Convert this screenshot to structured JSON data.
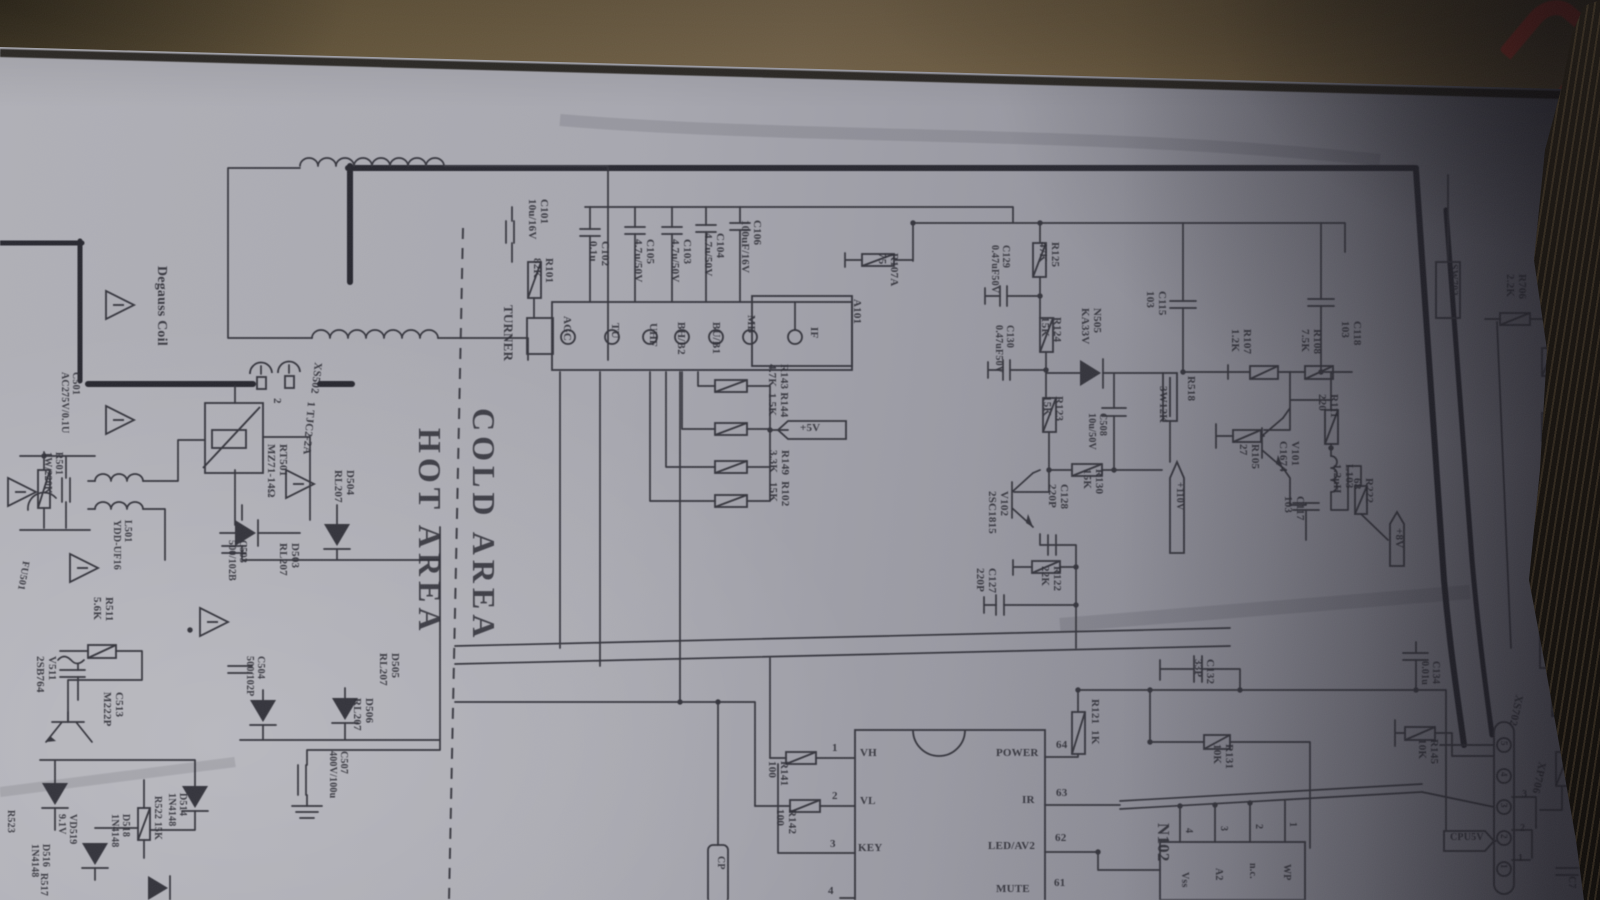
{
  "description": "Photograph of a CRT TV power/tuner schematic sheet lying on cardboard",
  "colors": {
    "paper": "#a7a7af",
    "cardboard": "#6a5a3e",
    "fabric": "#120e0a",
    "ink": "#33333b",
    "red_mark": "#9c2d24"
  },
  "areas": {
    "cold": "COLD AREA",
    "hot": "HOT AREA"
  },
  "labels": [
    {
      "n": "degauss-coil-label",
      "t": "Degauss Coil",
      "x": 168,
      "y": 266,
      "s": 14
    },
    {
      "n": "xs502-ref",
      "t": "XS502",
      "x": 323,
      "y": 363,
      "r": 97
    },
    {
      "n": "xs502-pin2",
      "t": "2",
      "x": 282,
      "y": 398
    },
    {
      "n": "xs502-pin1-type",
      "t": "1 TJC2-2A",
      "x": 316,
      "y": 402,
      "r": 95
    },
    {
      "n": "rt501-label",
      "t": "RT501\nMZ71-14Ω",
      "x": 288,
      "y": 444
    },
    {
      "n": "c501-label",
      "t": "C501\nAC275V/0.1U",
      "x": 80,
      "y": 372,
      "s": 10
    },
    {
      "n": "r501-label",
      "t": "R501\n1W/220K",
      "x": 63,
      "y": 452,
      "s": 10
    },
    {
      "n": "l501-label",
      "t": "L501\nYDD-UF16",
      "x": 132,
      "y": 520,
      "s": 10
    },
    {
      "n": "fu501-label",
      "t": "FU501",
      "x": 30,
      "y": 562,
      "s": 10,
      "r": 100
    },
    {
      "n": "r511-label",
      "t": "R511\n5.6K",
      "x": 114,
      "y": 597
    },
    {
      "n": "v511-label",
      "t": "V511\n2SB764",
      "x": 57,
      "y": 656
    },
    {
      "n": "c513-label",
      "t": "C513\nM222P",
      "x": 124,
      "y": 692
    },
    {
      "n": "d514-label",
      "t": "D514\n1N4148",
      "x": 187,
      "y": 793,
      "s": 10
    },
    {
      "n": "r522-label",
      "t": "R522 15K",
      "x": 162,
      "y": 796,
      "s": 10
    },
    {
      "n": "d518-label",
      "t": "D518\n1N4148",
      "x": 130,
      "y": 814,
      "s": 10
    },
    {
      "n": "vd519-label",
      "t": "VD519\n9.1V",
      "x": 77,
      "y": 814,
      "s": 10
    },
    {
      "n": "d516-label",
      "t": "D516\n1N4148",
      "x": 50,
      "y": 844,
      "s": 10
    },
    {
      "n": "r523-label",
      "t": "R523",
      "x": 15,
      "y": 810,
      "s": 10
    },
    {
      "n": "r517-label",
      "t": "R517",
      "x": 48,
      "y": 873,
      "s": 10
    },
    {
      "n": "d503-label",
      "t": "D503\nRL207",
      "x": 300,
      "y": 543
    },
    {
      "n": "d504-label",
      "t": "D504\nRL207",
      "x": 355,
      "y": 470
    },
    {
      "n": "c503-label",
      "t": "C503\n500/102B",
      "x": 247,
      "y": 540,
      "s": 10
    },
    {
      "n": "c504-label",
      "t": "C504\n500/102P",
      "x": 265,
      "y": 656,
      "s": 10
    },
    {
      "n": "d505-label",
      "t": "D505\nRL207",
      "x": 400,
      "y": 653
    },
    {
      "n": "d506-label",
      "t": "D506\nRL207",
      "x": 374,
      "y": 698
    },
    {
      "n": "c507-label",
      "t": "C507\n400V/100u",
      "x": 348,
      "y": 751,
      "s": 10
    },
    {
      "n": "tuner-label",
      "t": "TURNER",
      "x": 515,
      "y": 305,
      "s": 13
    },
    {
      "n": "c101-label",
      "t": "C101\n10u/16V",
      "x": 549,
      "y": 199
    },
    {
      "n": "r101-label",
      "t": "R101\n82K",
      "x": 554,
      "y": 258
    },
    {
      "n": "c102-label",
      "t": "C102\n0.1u",
      "x": 610,
      "y": 241
    },
    {
      "n": "c105-label",
      "t": "C105\n4.7u/50V",
      "x": 655,
      "y": 239
    },
    {
      "n": "c103-label",
      "t": "C103\n4.7u/50V",
      "x": 692,
      "y": 239
    },
    {
      "n": "c104-label",
      "t": "C104\n4.7u/50V",
      "x": 725,
      "y": 233
    },
    {
      "n": "c106-label",
      "t": "C106\n100uF/16V",
      "x": 762,
      "y": 220
    },
    {
      "n": "tuner-pin-agc",
      "t": "AGC",
      "x": 572,
      "y": 316
    },
    {
      "n": "tuner-pin-tu",
      "t": "TU",
      "x": 620,
      "y": 323
    },
    {
      "n": "tuner-pin-uhf",
      "t": "UHF",
      "x": 658,
      "y": 323
    },
    {
      "n": "tuner-pin-bhb2",
      "t": "BH/B2",
      "x": 686,
      "y": 322
    },
    {
      "n": "tuner-pin-bub1",
      "t": "BU/B1",
      "x": 721,
      "y": 322
    },
    {
      "n": "tuner-pin-mb",
      "t": "MB",
      "x": 756,
      "y": 315
    },
    {
      "n": "tuner-pin-if",
      "t": "IF",
      "x": 819,
      "y": 327
    },
    {
      "n": "a101-label",
      "t": "A101",
      "x": 862,
      "y": 299
    },
    {
      "n": "r143-r144-label",
      "t": "R143 R144\n4.7K  1.5K",
      "x": 789,
      "y": 364
    },
    {
      "n": "r149-r102-label",
      "t": "R149  R102\n3.3K   15K",
      "x": 790,
      "y": 450
    },
    {
      "n": "flag-5v-label",
      "t": "+5V",
      "x": 800,
      "y": 423,
      "r": "h"
    },
    {
      "n": "r107a-label",
      "t": "R107A\n75",
      "x": 899,
      "y": 253
    },
    {
      "n": "r125-label",
      "t": "R125\n47K",
      "x": 1060,
      "y": 242
    },
    {
      "n": "c129-label",
      "t": "C129\n0.47uF50V",
      "x": 1010,
      "y": 245,
      "s": 10
    },
    {
      "n": "r124-label",
      "t": "R124\n15K",
      "x": 1062,
      "y": 317
    },
    {
      "n": "c130-label",
      "t": "C130\n0.47uF50V",
      "x": 1014,
      "y": 325,
      "s": 10
    },
    {
      "n": "n505-label",
      "t": "N505\nKA33V",
      "x": 1102,
      "y": 308
    },
    {
      "n": "r123-label",
      "t": "R123\n15K",
      "x": 1064,
      "y": 396
    },
    {
      "n": "c508-label",
      "t": "C508\n10u/50V",
      "x": 1107,
      "y": 413,
      "s": 10
    },
    {
      "n": "r130-label",
      "t": "R130\n15K",
      "x": 1104,
      "y": 469
    },
    {
      "n": "r518-ref",
      "t": "R518",
      "x": 1196,
      "y": 376
    },
    {
      "n": "r518-val",
      "t": "3W12K",
      "x": 1168,
      "y": 386
    },
    {
      "n": "flag-110v-label",
      "t": "+110V",
      "x": 1184,
      "y": 482,
      "s": 10
    },
    {
      "n": "v102-label",
      "t": "V102\n2SC1815",
      "x": 1009,
      "y": 491
    },
    {
      "n": "c128-label",
      "t": "C128\n220P",
      "x": 1069,
      "y": 484
    },
    {
      "n": "r122-label",
      "t": "R122\n22K",
      "x": 1062,
      "y": 566
    },
    {
      "n": "c127-label",
      "t": "C127\n220P",
      "x": 997,
      "y": 568
    },
    {
      "n": "c115-label",
      "t": "C115\n103",
      "x": 1167,
      "y": 291
    },
    {
      "n": "c118-label",
      "t": "C118\n103",
      "x": 1362,
      "y": 321
    },
    {
      "n": "r107-label",
      "t": "R107\n1.2K",
      "x": 1252,
      "y": 329
    },
    {
      "n": "r108-label",
      "t": "R108\n7.5K",
      "x": 1322,
      "y": 329
    },
    {
      "n": "r111-label",
      "t": "R111\n220",
      "x": 1339,
      "y": 394
    },
    {
      "n": "v101-label",
      "t": "V101\nC1674",
      "x": 1300,
      "y": 441
    },
    {
      "n": "r105-label",
      "t": "R105\n27",
      "x": 1260,
      "y": 444
    },
    {
      "n": "l103-label",
      "t": "L103\n1.2uH",
      "x": 1354,
      "y": 464
    },
    {
      "n": "c117-label",
      "t": "C117\n103",
      "x": 1305,
      "y": 496
    },
    {
      "n": "r222-label",
      "t": "R222\n68",
      "x": 1374,
      "y": 478
    },
    {
      "n": "flag-8v-label",
      "t": "+8V",
      "x": 1404,
      "y": 528
    },
    {
      "n": "ic-pin1-num",
      "t": "1",
      "x": 832,
      "y": 743,
      "r": "h"
    },
    {
      "n": "ic-pin-vh",
      "t": "VH",
      "x": 860,
      "y": 748,
      "r": "h"
    },
    {
      "n": "ic-pin2-num",
      "t": "2",
      "x": 832,
      "y": 791,
      "r": "h"
    },
    {
      "n": "ic-pin-vl",
      "t": "VL",
      "x": 860,
      "y": 796,
      "r": "h"
    },
    {
      "n": "ic-pin3-num",
      "t": "3",
      "x": 830,
      "y": 839,
      "r": "h"
    },
    {
      "n": "ic-pin-key",
      "t": "KEY",
      "x": 858,
      "y": 843,
      "r": "h"
    },
    {
      "n": "ic-pin4-num",
      "t": "4",
      "x": 828,
      "y": 886,
      "r": "h"
    },
    {
      "n": "ic-pin-power",
      "t": "POWER",
      "x": 996,
      "y": 748,
      "r": "h"
    },
    {
      "n": "ic-pin64-num",
      "t": "64",
      "x": 1056,
      "y": 740,
      "r": "h"
    },
    {
      "n": "ic-pin-ir",
      "t": "IR",
      "x": 1022,
      "y": 795,
      "r": "h"
    },
    {
      "n": "ic-pin63-num",
      "t": "63",
      "x": 1056,
      "y": 788,
      "r": "h"
    },
    {
      "n": "ic-pin-ledav2",
      "t": "LED/AV2",
      "x": 988,
      "y": 841,
      "r": "h"
    },
    {
      "n": "ic-pin62-num",
      "t": "62",
      "x": 1055,
      "y": 833,
      "r": "h"
    },
    {
      "n": "ic-pin-mute",
      "t": "MUTE",
      "x": 996,
      "y": 884,
      "r": "h"
    },
    {
      "n": "ic-pin61-num",
      "t": "61",
      "x": 1054,
      "y": 878,
      "r": "h"
    },
    {
      "n": "r141-label",
      "t": "R141\n100",
      "x": 789,
      "y": 761
    },
    {
      "n": "r142-label",
      "t": "R142\n100",
      "x": 797,
      "y": 809
    },
    {
      "n": "r121-label",
      "t": "R121  1K",
      "x": 1100,
      "y": 699
    },
    {
      "n": "cp-box-label",
      "t": "CP",
      "x": 725,
      "y": 856,
      "s": 10
    },
    {
      "n": "c132-label",
      "t": "C132\n33P",
      "x": 1215,
      "y": 659
    },
    {
      "n": "r131-label",
      "t": "R131\n10K",
      "x": 1234,
      "y": 744
    },
    {
      "n": "c134-label",
      "t": "C134\n0.01u",
      "x": 1440,
      "y": 661,
      "s": 10
    },
    {
      "n": "r145-label",
      "t": "R145\n10K",
      "x": 1439,
      "y": 739
    },
    {
      "n": "n102-ref",
      "t": "N102",
      "x": 1172,
      "y": 823,
      "s": 17
    },
    {
      "n": "mem-pin4-num",
      "t": "4",
      "x": 1193,
      "y": 828,
      "s": 10
    },
    {
      "n": "mem-pin3-num",
      "t": "3",
      "x": 1228,
      "y": 826,
      "s": 10
    },
    {
      "n": "mem-pin2-num",
      "t": "2",
      "x": 1263,
      "y": 824,
      "s": 10
    },
    {
      "n": "mem-pin1-num",
      "t": "1",
      "x": 1297,
      "y": 822,
      "s": 10
    },
    {
      "n": "mem-pin-vss",
      "t": "Vss",
      "x": 1189,
      "y": 872,
      "s": 10
    },
    {
      "n": "mem-pin-a2",
      "t": "A2",
      "x": 1223,
      "y": 868,
      "s": 10
    },
    {
      "n": "mem-pin-nc",
      "t": "n.c.",
      "x": 1257,
      "y": 863,
      "s": 10
    },
    {
      "n": "mem-pin-wp",
      "t": "WP",
      "x": 1291,
      "y": 864,
      "s": 10
    },
    {
      "n": "sw702-label",
      "t": "SW702",
      "x": 1458,
      "y": 264,
      "s": 10
    },
    {
      "n": "r706-label",
      "t": "R706\n2.2K",
      "x": 1527,
      "y": 274
    },
    {
      "n": "sw703-label",
      "t": "SW703",
      "x": 1579,
      "y": 273,
      "s": 10
    },
    {
      "n": "r705-label",
      "t": "R705\n2.7K",
      "x": 1567,
      "y": 333
    },
    {
      "n": "r704-label",
      "t": "R704\n3.9K",
      "x": 1572,
      "y": 394
    },
    {
      "n": "r703-label",
      "t": "R703\n4.7K",
      "x": 1574,
      "y": 456
    },
    {
      "n": "r702-label",
      "t": "R702\n8.2K",
      "x": 1576,
      "y": 519
    },
    {
      "n": "r701-label",
      "t": "R701\n27K",
      "x": 1574,
      "y": 583
    },
    {
      "n": "r700-ref",
      "t": "R700",
      "x": 1567,
      "y": 634
    },
    {
      "n": "r700-val",
      "t": "150K",
      "x": 1573,
      "y": 662
    },
    {
      "n": "r727-label",
      "t": "R727\n470",
      "x": 1584,
      "y": 703
    },
    {
      "n": "r728a-label",
      "t": "R728A\n100",
      "x": 1585,
      "y": 744,
      "s": 10
    },
    {
      "n": "xs702-ref",
      "t": "XS702",
      "x": 1524,
      "y": 696,
      "r": 102
    },
    {
      "n": "xp706-ref",
      "t": "XP706",
      "x": 1547,
      "y": 763,
      "r": 102
    },
    {
      "n": "flag-cpu5v-label",
      "t": "CPU5V",
      "x": 1450,
      "y": 833,
      "r": "h",
      "s": 10
    },
    {
      "n": "conn-num3",
      "t": "3",
      "x": 1522,
      "y": 790,
      "r": "h",
      "s": 10
    },
    {
      "n": "conn-num2",
      "t": "2",
      "x": 1520,
      "y": 824,
      "r": "h",
      "s": 10
    },
    {
      "n": "conn-num1",
      "t": "1",
      "x": 1518,
      "y": 854,
      "r": "h",
      "s": 10
    },
    {
      "n": "xs702-pin5",
      "t": "5",
      "x": 1508,
      "y": 741,
      "s": 9
    },
    {
      "n": "xs702-pin4",
      "t": "4",
      "x": 1508,
      "y": 772,
      "s": 9
    },
    {
      "n": "xs702-pin3",
      "t": "3",
      "x": 1508,
      "y": 803,
      "s": 9
    },
    {
      "n": "xs702-pin2",
      "t": "2",
      "x": 1508,
      "y": 834,
      "s": 9
    },
    {
      "n": "xs702-pin1",
      "t": "1",
      "x": 1508,
      "y": 864,
      "s": 9
    },
    {
      "n": "c7xx-ref",
      "t": "C7",
      "x": 1576,
      "y": 876,
      "s": 10
    },
    {
      "n": "c7xx-val",
      "t": "10u",
      "x": 1592,
      "y": 874,
      "s": 10
    }
  ]
}
